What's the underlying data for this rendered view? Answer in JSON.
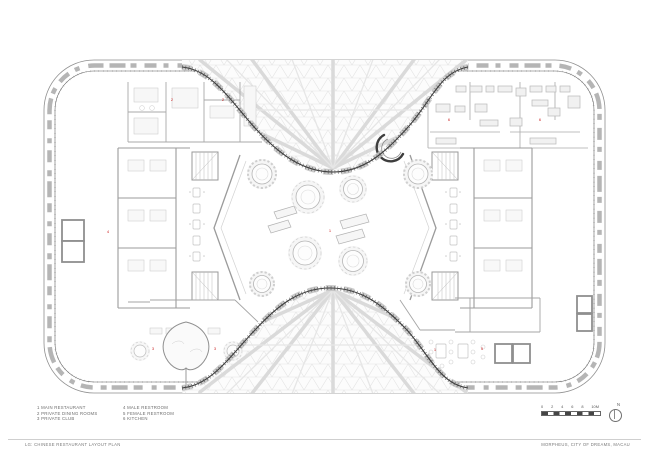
{
  "document": {
    "type": "architectural floor plan",
    "sheet_title": "LG: CHINESE RESTAURANT LAYOUT PLAN",
    "project_title": "MORPHEUS, CITY OF DREAMS, MACAU"
  },
  "legend": {
    "items": [
      "1 MAIN RESTAURANT",
      "2 PRIVATE DINING ROOMS",
      "3 PRIVATE CLUB",
      "4 MALE RESTROOM",
      "5 FEMALE RESTROOM",
      "6 KITCHEN"
    ]
  },
  "scale_bar": {
    "labels": [
      "0",
      "2",
      "4",
      "6",
      "8",
      "10M"
    ],
    "north_label": "N"
  },
  "plan": {
    "markers": [
      "2",
      "2",
      "6",
      "6",
      "1",
      "3",
      "3",
      "1",
      "5",
      "4"
    ],
    "colors": {
      "background": "#ffffff",
      "light_linework": "#c9c9c9",
      "walls": "#9a9a9a",
      "facade_mullions": "#b5b5b5",
      "void_edge": "#3a3a3a",
      "diagrid": "#e4e4e4",
      "room_marker": "#cc2626"
    }
  }
}
